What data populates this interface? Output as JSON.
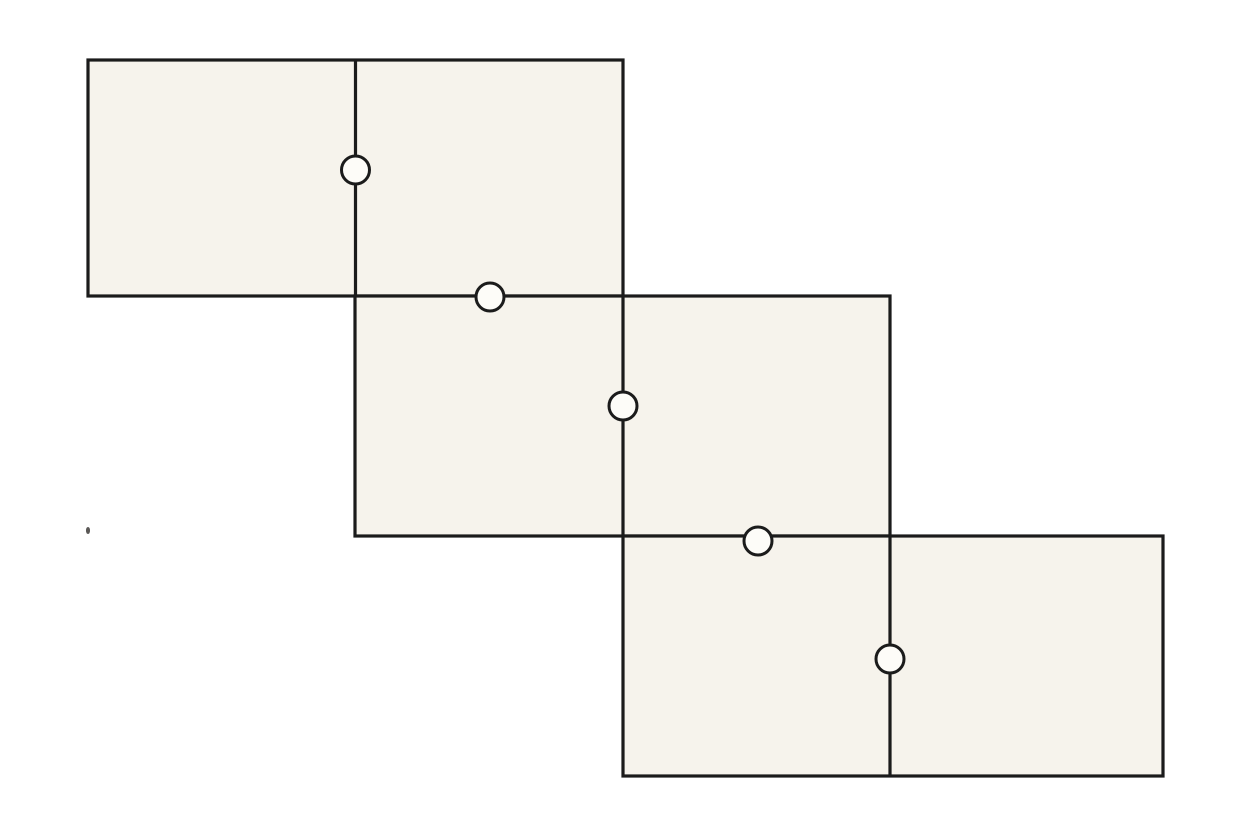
{
  "canvas": {
    "width": 1248,
    "height": 832,
    "background": "#ffffff"
  },
  "style": {
    "line_color": "#1b1b1b",
    "line_width": 3.2,
    "rect_fill": "#f6f3ec",
    "circle_fill": "#fdfcf8",
    "circle_stroke_width": 3,
    "circle_radius": 14
  },
  "figure": {
    "description": "Three identical rectangles arranged in a descending staircase, each bisected by a vertical midline, with five small hinge circles at midpoints of dividers and shared edges",
    "rectangles": [
      {
        "name": "rectangle-top-left",
        "x": 88,
        "y": 60,
        "width": 535,
        "height": 236,
        "divider_x": 355.5
      },
      {
        "name": "rectangle-middle",
        "x": 355,
        "y": 296,
        "width": 535,
        "height": 240,
        "divider_x": 623
      },
      {
        "name": "rectangle-bottom-right",
        "x": 623,
        "y": 536,
        "width": 540,
        "height": 240,
        "divider_x": 890
      }
    ],
    "circles": [
      {
        "name": "hinge-circle-1",
        "cx": 355.5,
        "cy": 170
      },
      {
        "name": "hinge-circle-2",
        "cx": 490,
        "cy": 297
      },
      {
        "name": "hinge-circle-3",
        "cx": 623,
        "cy": 406
      },
      {
        "name": "hinge-circle-4",
        "cx": 758,
        "cy": 541
      },
      {
        "name": "hinge-circle-5",
        "cx": 890,
        "cy": 659
      }
    ],
    "stray_mark": {
      "x": 86,
      "y": 527,
      "width": 4,
      "height": 7,
      "color": "#5a5856"
    }
  }
}
